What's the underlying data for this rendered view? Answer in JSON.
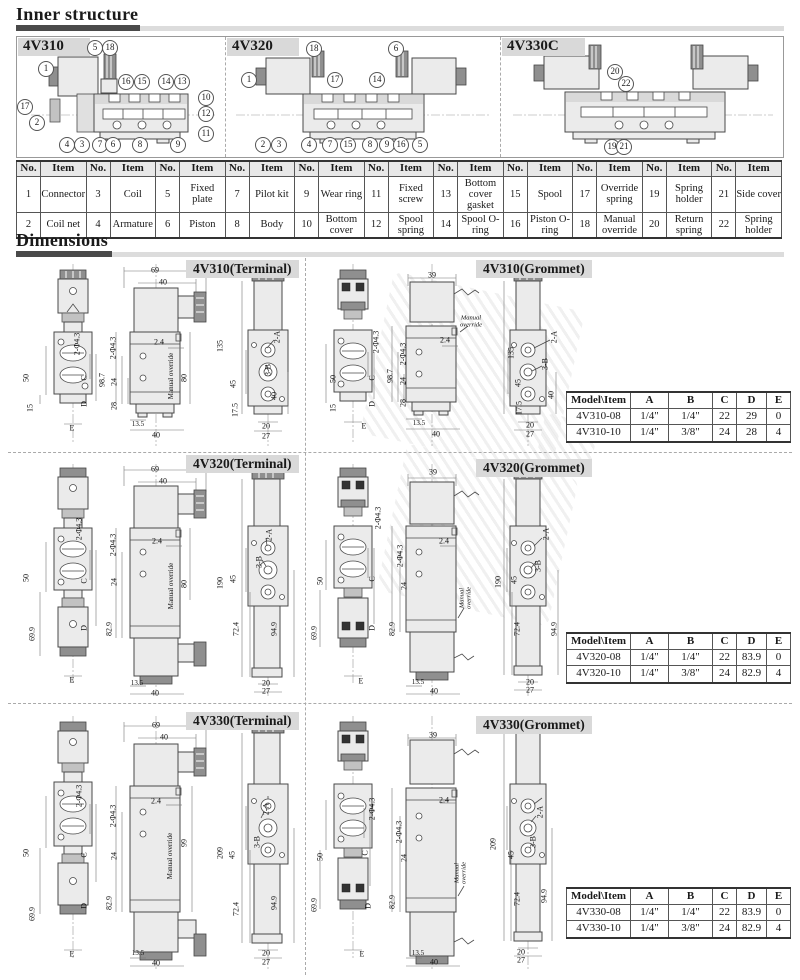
{
  "sections": {
    "inner_structure": "Inner structure",
    "dimensions": "Dimensions"
  },
  "inner": {
    "diagrams": [
      {
        "label": "4V310",
        "callouts": [
          {
            "n": "1",
            "x": 29,
            "y": 32
          },
          {
            "n": "5",
            "x": 78,
            "y": 11
          },
          {
            "n": "18",
            "x": 93,
            "y": 11
          },
          {
            "n": "17",
            "x": 8,
            "y": 70
          },
          {
            "n": "2",
            "x": 20,
            "y": 86
          },
          {
            "n": "16",
            "x": 109,
            "y": 45
          },
          {
            "n": "15",
            "x": 125,
            "y": 45
          },
          {
            "n": "14",
            "x": 149,
            "y": 45
          },
          {
            "n": "13",
            "x": 165,
            "y": 45
          },
          {
            "n": "10",
            "x": 189,
            "y": 61
          },
          {
            "n": "12",
            "x": 189,
            "y": 77
          },
          {
            "n": "11",
            "x": 189,
            "y": 97
          },
          {
            "n": "4",
            "x": 50,
            "y": 108
          },
          {
            "n": "3",
            "x": 65,
            "y": 108
          },
          {
            "n": "7",
            "x": 83,
            "y": 108
          },
          {
            "n": "6",
            "x": 96,
            "y": 108
          },
          {
            "n": "8",
            "x": 123,
            "y": 108
          },
          {
            "n": "9",
            "x": 161,
            "y": 108
          }
        ]
      },
      {
        "label": "4V320",
        "callouts": [
          {
            "n": "18",
            "x": 88,
            "y": 12
          },
          {
            "n": "6",
            "x": 170,
            "y": 12
          },
          {
            "n": "1",
            "x": 23,
            "y": 43
          },
          {
            "n": "17",
            "x": 109,
            "y": 43
          },
          {
            "n": "14",
            "x": 151,
            "y": 43
          },
          {
            "n": "2",
            "x": 37,
            "y": 108
          },
          {
            "n": "3",
            "x": 53,
            "y": 108
          },
          {
            "n": "4",
            "x": 83,
            "y": 108
          },
          {
            "n": "7",
            "x": 104,
            "y": 108
          },
          {
            "n": "15",
            "x": 122,
            "y": 108
          },
          {
            "n": "8",
            "x": 144,
            "y": 108
          },
          {
            "n": "9",
            "x": 161,
            "y": 108
          },
          {
            "n": "16",
            "x": 175,
            "y": 108
          },
          {
            "n": "5",
            "x": 194,
            "y": 108
          }
        ]
      },
      {
        "label": "4V330C",
        "callouts": [
          {
            "n": "20",
            "x": 114,
            "y": 35
          },
          {
            "n": "22",
            "x": 125,
            "y": 47
          },
          {
            "n": "19",
            "x": 111,
            "y": 110
          },
          {
            "n": "21",
            "x": 123,
            "y": 110
          }
        ]
      }
    ]
  },
  "parts_table": {
    "headers": [
      "No.",
      "Item",
      "No.",
      "Item",
      "No.",
      "Item",
      "No.",
      "Item",
      "No.",
      "Item",
      "No.",
      "Item",
      "No.",
      "Item",
      "No.",
      "Item",
      "No.",
      "Item",
      "No.",
      "Item",
      "No.",
      "Item"
    ],
    "rows": [
      [
        "1",
        "Connector",
        "3",
        "Coil",
        "5",
        "Fixed plate",
        "7",
        "Pilot kit",
        "9",
        "Wear ring",
        "11",
        "Fixed screw",
        "13",
        "Bottom cover gasket",
        "15",
        "Spool",
        "17",
        "Override spring",
        "19",
        "Spring holder",
        "21",
        "Side cover"
      ],
      [
        "2",
        "Coil net",
        "4",
        "Armature",
        "6",
        "Piston",
        "8",
        "Body",
        "10",
        "Bottom cover",
        "12",
        "Spool spring",
        "14",
        "Spool O-ring",
        "16",
        "Piston O-ring",
        "18",
        "Manual override",
        "20",
        "Return spring",
        "22",
        "Spring holder"
      ]
    ]
  },
  "dim_panels": [
    {
      "title": "4V310(Terminal)",
      "labels": [
        {
          "t": "69",
          "x": 139,
          "y": 12
        },
        {
          "t": "40",
          "x": 147,
          "y": 24
        },
        {
          "t": "2-Φ4.3",
          "x": 61,
          "y": 86,
          "r": 1
        },
        {
          "t": "50",
          "x": 10,
          "y": 120,
          "r": 1
        },
        {
          "t": "15",
          "x": 14,
          "y": 150,
          "r": 1
        },
        {
          "t": "C",
          "x": 68,
          "y": 120,
          "r": 1
        },
        {
          "t": "D",
          "x": 68,
          "y": 146,
          "r": 1
        },
        {
          "t": "E",
          "x": 56,
          "y": 170
        },
        {
          "t": "2-Φ4.3",
          "x": 97,
          "y": 90,
          "r": 1
        },
        {
          "t": "98.7",
          "x": 86,
          "y": 122,
          "r": 1
        },
        {
          "t": "24",
          "x": 98,
          "y": 124,
          "r": 1
        },
        {
          "t": "28",
          "x": 98,
          "y": 148,
          "r": 1
        },
        {
          "t": "2.4",
          "x": 143,
          "y": 84
        },
        {
          "t": "Manual override",
          "x": 155,
          "y": 118,
          "r": 1,
          "s": 1
        },
        {
          "t": "80",
          "x": 168,
          "y": 120,
          "r": 1
        },
        {
          "t": "13.5",
          "x": 122,
          "y": 166,
          "s": 1
        },
        {
          "t": "40",
          "x": 140,
          "y": 177
        },
        {
          "t": "135",
          "x": 204,
          "y": 88,
          "r": 1
        },
        {
          "t": "45",
          "x": 217,
          "y": 126,
          "r": 1
        },
        {
          "t": "17.5",
          "x": 219,
          "y": 152,
          "r": 1
        },
        {
          "t": "40",
          "x": 258,
          "y": 138,
          "r": 1
        },
        {
          "t": "20",
          "x": 250,
          "y": 168
        },
        {
          "t": "27",
          "x": 250,
          "y": 178
        },
        {
          "t": "2-A",
          "x": 261,
          "y": 79,
          "r": 1
        },
        {
          "t": "3-B",
          "x": 252,
          "y": 112,
          "r": 1
        }
      ]
    },
    {
      "title": "4V310(Grommet)",
      "labels": [
        {
          "t": "39",
          "x": 124,
          "y": 17
        },
        {
          "t": "2-Φ4.3",
          "x": 68,
          "y": 84,
          "r": 1
        },
        {
          "t": "50",
          "x": 25,
          "y": 121,
          "r": 1
        },
        {
          "t": "15",
          "x": 25,
          "y": 150,
          "r": 1
        },
        {
          "t": "C",
          "x": 64,
          "y": 120,
          "r": 1
        },
        {
          "t": "D",
          "x": 64,
          "y": 146,
          "r": 1
        },
        {
          "t": "E",
          "x": 56,
          "y": 168
        },
        {
          "t": "2-Φ4.3",
          "x": 95,
          "y": 96,
          "r": 1
        },
        {
          "t": "98.7",
          "x": 82,
          "y": 118,
          "r": 1
        },
        {
          "t": "24",
          "x": 95,
          "y": 123,
          "r": 1
        },
        {
          "t": "28",
          "x": 95,
          "y": 145,
          "r": 1
        },
        {
          "t": "2.4",
          "x": 137,
          "y": 82
        },
        {
          "t": "Manual\noverride",
          "x": 163,
          "y": 64,
          "ml": 1
        },
        {
          "t": "13.5",
          "x": 111,
          "y": 165,
          "s": 1
        },
        {
          "t": "40",
          "x": 128,
          "y": 176
        },
        {
          "t": "135",
          "x": 203,
          "y": 95,
          "r": 1
        },
        {
          "t": "45",
          "x": 210,
          "y": 125,
          "r": 1
        },
        {
          "t": "17.5",
          "x": 211,
          "y": 150,
          "r": 1
        },
        {
          "t": "40",
          "x": 243,
          "y": 137,
          "r": 1
        },
        {
          "t": "20",
          "x": 222,
          "y": 167
        },
        {
          "t": "27",
          "x": 222,
          "y": 176
        },
        {
          "t": "2-A",
          "x": 246,
          "y": 79,
          "r": 1
        },
        {
          "t": "3-B",
          "x": 237,
          "y": 106,
          "r": 1
        }
      ]
    },
    {
      "title": "4V320(Terminal)",
      "labels": [
        {
          "t": "69",
          "x": 139,
          "y": 11
        },
        {
          "t": "40",
          "x": 147,
          "y": 23
        },
        {
          "t": "2-Φ4.3",
          "x": 63,
          "y": 71,
          "r": 1
        },
        {
          "t": "50",
          "x": 10,
          "y": 120,
          "r": 1
        },
        {
          "t": "C",
          "x": 68,
          "y": 123,
          "r": 1
        },
        {
          "t": "69.9",
          "x": 16,
          "y": 176,
          "r": 1
        },
        {
          "t": "D",
          "x": 68,
          "y": 170,
          "r": 1
        },
        {
          "t": "E",
          "x": 56,
          "y": 222
        },
        {
          "t": "2-Φ4.3",
          "x": 97,
          "y": 87,
          "r": 1
        },
        {
          "t": "24",
          "x": 98,
          "y": 124,
          "r": 1
        },
        {
          "t": "82.9",
          "x": 93,
          "y": 171,
          "r": 1
        },
        {
          "t": "2.4",
          "x": 141,
          "y": 83
        },
        {
          "t": "Manual override",
          "x": 155,
          "y": 128,
          "r": 1,
          "s": 1
        },
        {
          "t": "80",
          "x": 168,
          "y": 126,
          "r": 1
        },
        {
          "t": "13.5",
          "x": 121,
          "y": 225,
          "s": 1
        },
        {
          "t": "40",
          "x": 139,
          "y": 235
        },
        {
          "t": "190",
          "x": 204,
          "y": 125,
          "r": 1
        },
        {
          "t": "45",
          "x": 217,
          "y": 121,
          "r": 1
        },
        {
          "t": "72.4",
          "x": 220,
          "y": 171,
          "r": 1
        },
        {
          "t": "94.9",
          "x": 258,
          "y": 171,
          "r": 1
        },
        {
          "t": "20",
          "x": 250,
          "y": 225
        },
        {
          "t": "27",
          "x": 250,
          "y": 233
        },
        {
          "t": "2-A",
          "x": 253,
          "y": 77,
          "r": 1
        },
        {
          "t": "3-B",
          "x": 243,
          "y": 104,
          "r": 1
        }
      ]
    },
    {
      "title": "4V320(Grommet)",
      "labels": [
        {
          "t": "39",
          "x": 125,
          "y": 14
        },
        {
          "t": "2-Φ4.3",
          "x": 70,
          "y": 60,
          "r": 1
        },
        {
          "t": "50",
          "x": 12,
          "y": 123,
          "r": 1
        },
        {
          "t": "C",
          "x": 64,
          "y": 121,
          "r": 1
        },
        {
          "t": "69.9",
          "x": 6,
          "y": 175,
          "r": 1
        },
        {
          "t": "D",
          "x": 64,
          "y": 170,
          "r": 1
        },
        {
          "t": "E",
          "x": 53,
          "y": 223
        },
        {
          "t": "2-Φ4.3",
          "x": 92,
          "y": 98,
          "r": 1
        },
        {
          "t": "24",
          "x": 96,
          "y": 128,
          "r": 1
        },
        {
          "t": "82.9",
          "x": 84,
          "y": 171,
          "r": 1
        },
        {
          "t": "2.4",
          "x": 136,
          "y": 83
        },
        {
          "t": "Manual\noverride",
          "x": 158,
          "y": 140,
          "r": 1,
          "ml": 1
        },
        {
          "t": "13.5",
          "x": 110,
          "y": 224,
          "s": 1
        },
        {
          "t": "40",
          "x": 126,
          "y": 233
        },
        {
          "t": "190",
          "x": 190,
          "y": 124,
          "r": 1
        },
        {
          "t": "45",
          "x": 206,
          "y": 122,
          "r": 1
        },
        {
          "t": "72.4",
          "x": 209,
          "y": 171,
          "r": 1
        },
        {
          "t": "94.9",
          "x": 246,
          "y": 171,
          "r": 1
        },
        {
          "t": "20",
          "x": 222,
          "y": 224
        },
        {
          "t": "27",
          "x": 222,
          "y": 232
        },
        {
          "t": "2-A",
          "x": 238,
          "y": 76,
          "r": 1
        },
        {
          "t": "3-B",
          "x": 230,
          "y": 108,
          "r": 1
        }
      ]
    },
    {
      "title": "4V330(Terminal)",
      "labels": [
        {
          "t": "69",
          "x": 140,
          "y": 17
        },
        {
          "t": "40",
          "x": 148,
          "y": 29
        },
        {
          "t": "2-Φ4.3",
          "x": 63,
          "y": 88,
          "r": 1
        },
        {
          "t": "50",
          "x": 10,
          "y": 145,
          "r": 1
        },
        {
          "t": "C",
          "x": 68,
          "y": 147,
          "r": 1
        },
        {
          "t": "69.9",
          "x": 16,
          "y": 206,
          "r": 1
        },
        {
          "t": "D",
          "x": 68,
          "y": 198,
          "r": 1
        },
        {
          "t": "E",
          "x": 56,
          "y": 246
        },
        {
          "t": "2-Φ4.3",
          "x": 97,
          "y": 108,
          "r": 1
        },
        {
          "t": "24",
          "x": 98,
          "y": 148,
          "r": 1
        },
        {
          "t": "82.9",
          "x": 93,
          "y": 195,
          "r": 1
        },
        {
          "t": "2.4",
          "x": 140,
          "y": 93
        },
        {
          "t": "Manual override",
          "x": 154,
          "y": 148,
          "r": 1,
          "s": 1
        },
        {
          "t": "99",
          "x": 168,
          "y": 135,
          "r": 1
        },
        {
          "t": "13.5",
          "x": 122,
          "y": 245,
          "s": 1
        },
        {
          "t": "40",
          "x": 140,
          "y": 255
        },
        {
          "t": "209",
          "x": 204,
          "y": 145,
          "r": 1
        },
        {
          "t": "45",
          "x": 216,
          "y": 147,
          "r": 1
        },
        {
          "t": "72.4",
          "x": 220,
          "y": 201,
          "r": 1
        },
        {
          "t": "94.9",
          "x": 258,
          "y": 195,
          "r": 1
        },
        {
          "t": "20",
          "x": 250,
          "y": 245
        },
        {
          "t": "27",
          "x": 250,
          "y": 254
        },
        {
          "t": "2-A",
          "x": 250,
          "y": 101,
          "r": 1
        },
        {
          "t": "3-B",
          "x": 241,
          "y": 134,
          "r": 1
        }
      ]
    },
    {
      "title": "4V330(Grommet)",
      "labels": [
        {
          "t": "39",
          "x": 125,
          "y": 27
        },
        {
          "t": "2-Φ4.3",
          "x": 64,
          "y": 101,
          "r": 1
        },
        {
          "t": "50",
          "x": 12,
          "y": 149,
          "r": 1
        },
        {
          "t": "C",
          "x": 57,
          "y": 145,
          "r": 1
        },
        {
          "t": "69.9",
          "x": 6,
          "y": 197,
          "r": 1
        },
        {
          "t": "D",
          "x": 60,
          "y": 198,
          "r": 1
        },
        {
          "t": "E",
          "x": 54,
          "y": 246
        },
        {
          "t": "2-Φ4.3",
          "x": 91,
          "y": 124,
          "r": 1
        },
        {
          "t": "24",
          "x": 96,
          "y": 150,
          "r": 1
        },
        {
          "t": "82.9",
          "x": 84,
          "y": 194,
          "r": 1
        },
        {
          "t": "2.4",
          "x": 136,
          "y": 92
        },
        {
          "t": "Manual\noverride",
          "x": 153,
          "y": 165,
          "r": 1,
          "ml": 1
        },
        {
          "t": "13.5",
          "x": 110,
          "y": 245,
          "s": 1
        },
        {
          "t": "40",
          "x": 126,
          "y": 254
        },
        {
          "t": "209",
          "x": 185,
          "y": 136,
          "r": 1
        },
        {
          "t": "45",
          "x": 203,
          "y": 147,
          "r": 1
        },
        {
          "t": "72.4",
          "x": 209,
          "y": 191,
          "r": 1
        },
        {
          "t": "94.9",
          "x": 236,
          "y": 188,
          "r": 1
        },
        {
          "t": "20",
          "x": 213,
          "y": 244
        },
        {
          "t": "27",
          "x": 213,
          "y": 252
        },
        {
          "t": "2-A",
          "x": 232,
          "y": 104,
          "r": 1
        },
        {
          "t": "3-B",
          "x": 225,
          "y": 134,
          "r": 1
        }
      ]
    }
  ],
  "model_tables": [
    {
      "headers": [
        "Model\\Item",
        "A",
        "B",
        "C",
        "D",
        "E"
      ],
      "rows": [
        [
          "4V310-08",
          "1/4\"",
          "1/4\"",
          "22",
          "29",
          "0"
        ],
        [
          "4V310-10",
          "1/4\"",
          "3/8\"",
          "24",
          "28",
          "4"
        ]
      ]
    },
    {
      "headers": [
        "Model\\Item",
        "A",
        "B",
        "C",
        "D",
        "E"
      ],
      "rows": [
        [
          "4V320-08",
          "1/4\"",
          "1/4\"",
          "22",
          "83.9",
          "0"
        ],
        [
          "4V320-10",
          "1/4\"",
          "3/8\"",
          "24",
          "82.9",
          "4"
        ]
      ]
    },
    {
      "headers": [
        "Model\\Item",
        "A",
        "B",
        "C",
        "D",
        "E"
      ],
      "rows": [
        [
          "4V330-08",
          "1/4\"",
          "1/4\"",
          "22",
          "83.9",
          "0"
        ],
        [
          "4V330-10",
          "1/4\"",
          "3/8\"",
          "24",
          "82.9",
          "4"
        ]
      ]
    }
  ]
}
